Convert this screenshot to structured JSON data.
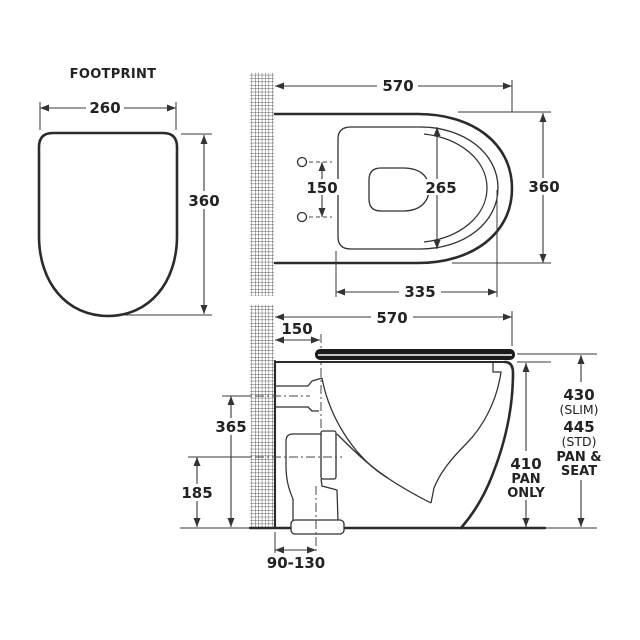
{
  "footprint": {
    "title": "FOOTPRINT",
    "width": "260",
    "depth": "360"
  },
  "top_view": {
    "width": "570",
    "depth": "360",
    "seat_inner_depth": "265",
    "seat_length": "335",
    "fixing_centres": "150"
  },
  "side_view": {
    "length": "570",
    "fixing_setout": "150",
    "inlet_centre_height": "365",
    "outlet_centre_height": "185",
    "pan_height": "410",
    "pan_only_l1": "PAN",
    "pan_only_l2": "ONLY",
    "slim_height": "430",
    "slim_label": "(SLIM)",
    "std_height": "445",
    "std_label": "(STD)",
    "pan_seat_l1": "PAN &",
    "pan_seat_l2": "SEAT",
    "outlet_setout_range": "90-130"
  },
  "colors": {
    "line": "#2b2b2b",
    "dimension": "#3a3a3a",
    "text": "#222222",
    "seat_lid_fill": "#1c1c1c",
    "background": "#ffffff"
  }
}
